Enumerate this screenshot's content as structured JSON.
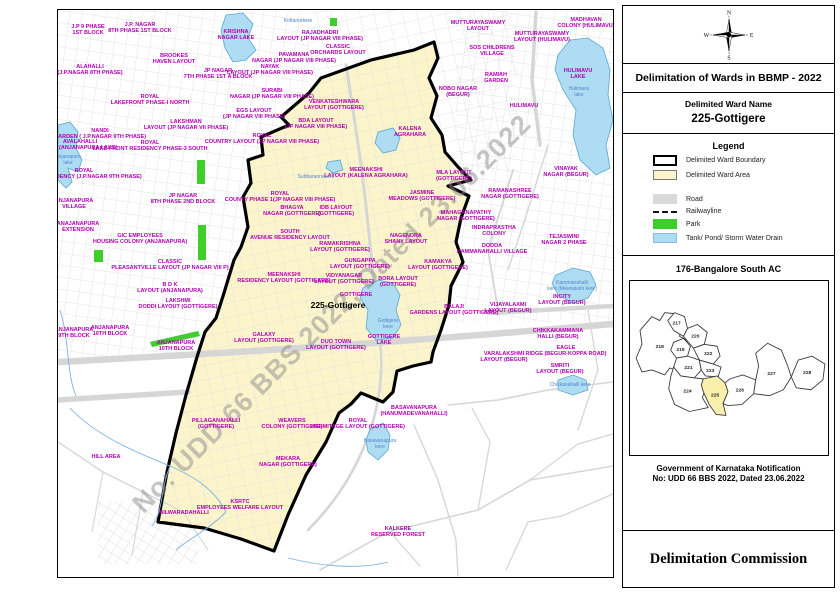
{
  "panel": {
    "title": "Delimitation of Wards in BBMP - 2022",
    "ward_name_label": "Delimited Ward Name",
    "ward_name": "225-Gottigere",
    "compass": {
      "n": "N",
      "e": "E",
      "s": "S",
      "w": "W"
    },
    "legend": {
      "title": "Legend",
      "items": [
        {
          "label": "Delimited Ward Boundary"
        },
        {
          "label": "Delimited Ward Area"
        },
        {
          "label": "Road"
        },
        {
          "label": "Railwayline"
        },
        {
          "label": "Park"
        },
        {
          "label": "Tank/ Pond/ Storm Water Drain"
        }
      ]
    },
    "ac": {
      "title": "176-Bangalore South AC",
      "highlighted_ward": "225",
      "shapes": [
        {
          "pts": "10,50 22,36 30,40 35,32 45,33 43,45 52,44 50,56 58,60 54,70 60,80 50,84 52,92 40,88 35,95 22,90 12,92 6,78 12,64"
        },
        {
          "pts": "38,40 45,32 55,36 58,48 54,56 44,50"
        },
        {
          "pts": "58,48 68,44 78,52 75,64 64,68 54,56"
        },
        {
          "pts": "44,62 54,58 61,66 58,76 47,78 41,70"
        },
        {
          "pts": "64,68 75,64 88,66 91,76 84,84 70,80"
        },
        {
          "pts": "47,78 58,76 70,80 72,90 65,98 51,96 44,87"
        },
        {
          "pts": "70,80 84,84 92,87 89,97 76,96 72,90"
        },
        {
          "pts": "44,87 51,96 65,98 74,99 77,107 73,118 79,128 60,132 45,125 39,109 41,97"
        },
        {
          "pts": "74,99 88,96 96,103 99,112 94,124 97,136 87,135 80,125 74,112 72,105",
          "hl": true
        },
        {
          "pts": "99,112 96,103 101,99 114,95 127,100 125,114 113,125 99,126 94,124"
        },
        {
          "pts": "127,100 130,86 127,73 139,63 153,70 159,85 163,97 155,110 141,116 125,114"
        },
        {
          "pts": "163,97 170,80 184,76 197,84 195,100 183,110 168,108"
        }
      ],
      "wards": [
        {
          "t": "218",
          "x": 30,
          "y": 68
        },
        {
          "t": "217",
          "x": 47,
          "y": 44
        },
        {
          "t": "220",
          "x": 66,
          "y": 57
        },
        {
          "t": "219",
          "x": 51,
          "y": 71
        },
        {
          "t": "222",
          "x": 79,
          "y": 75
        },
        {
          "t": "221",
          "x": 59,
          "y": 89
        },
        {
          "t": "223",
          "x": 81,
          "y": 92
        },
        {
          "t": "224",
          "x": 58,
          "y": 113
        },
        {
          "t": "225",
          "x": 86,
          "y": 117
        },
        {
          "t": "226",
          "x": 111,
          "y": 112
        },
        {
          "t": "227",
          "x": 143,
          "y": 95
        },
        {
          "t": "228",
          "x": 179,
          "y": 94
        }
      ]
    },
    "notification_line1": "Government of Karnataka Notification",
    "notification_line2": "No: UDD 66 BBS 2022, Dated 23.06.2022",
    "commission": "Delimitation Commission"
  },
  "map": {
    "watermark": "No: UDD 66 BBS 2022, Dated 23.06.2022",
    "colors": {
      "ward_area": "#FCF5CC",
      "boundary": "#000000",
      "water": "#AEDCF2",
      "park": "#3ECF2B",
      "road": "#D6D6D6",
      "label_magenta": "#B100B1",
      "label_blue": "#4F86C6"
    },
    "geometry": {
      "ward": "376,32 380,48 371,68 379,86 373,108 384,125 387,142 401,158 413,170 390,176 411,186 403,208 398,232 405,252 393,276 391,295 383,320 375,342 373,352 355,356 339,361 335,382 325,392 303,383 293,394 281,403 268,432 248,465 230,505 216,541 183,529 146,518 100,512 109,462 118,423 128,385 139,347 147,322 158,308 166,283 176,250 183,237 190,217 185,187 193,173 190,150 205,145 203,127 231,115 223,107 251,83 263,68 313,50 356,40",
      "pattern_rects": [
        {
          "x": 0,
          "y": 0,
          "w": 252,
          "h": 348,
          "p": "stA"
        },
        {
          "x": 252,
          "y": 0,
          "w": 206,
          "h": 162,
          "p": "stB"
        },
        {
          "x": 398,
          "y": 0,
          "w": 157,
          "h": 312,
          "p": "stA"
        },
        {
          "x": 40,
          "y": 492,
          "w": 100,
          "h": 62,
          "p": "stC"
        }
      ],
      "roads": [
        {
          "d": "M0,352 C150,344 300,336 555,314",
          "w": 6.5
        },
        {
          "d": "M0,390 L130,382",
          "w": 5.5
        },
        {
          "d": "M432,303 L555,296",
          "w": 4.5
        },
        {
          "d": "M478,2 L474,70 L482,135",
          "w": 3.5
        },
        {
          "d": "M288,55 C300,130 310,200 315,270",
          "w": 3
        },
        {
          "d": "M315,270 L322,330 C330,400 300,470 250,520",
          "w": 2.6
        },
        {
          "d": "M455,160 L430,240 L440,300",
          "w": 1.8
        },
        {
          "d": "M390,395 L440,390 L490,380 L555,372",
          "w": 1.6
        },
        {
          "d": "M356,415 L380,470 L398,530 L400,566",
          "w": 1.4
        },
        {
          "d": "M490,135 L470,200 L450,260",
          "w": 1.4
        },
        {
          "d": "M530,300 L540,360 L520,420",
          "w": 1.3
        },
        {
          "d": "M262,560 L330,522 L420,500 L472,470 L555,456",
          "w": 1.6
        },
        {
          "d": "M420,500 L432,432 L414,398",
          "w": 1.3
        },
        {
          "d": "M472,470 L520,434 L555,424",
          "w": 1.3
        },
        {
          "d": "M332,522 L362,556",
          "w": 1.3
        },
        {
          "d": "M448,560 L470,512 L504,506 L555,484",
          "w": 1.3
        },
        {
          "d": "M0,432 L45,462 L85,482 L125,502",
          "w": 1.3
        },
        {
          "d": "M45,462 L34,522",
          "w": 1.1
        },
        {
          "d": "M85,482 L74,545",
          "w": 1.1
        },
        {
          "d": "M125,502 L150,540",
          "w": 1.1
        }
      ],
      "parks": [
        "139,150 147,150 147,174 139,174",
        "140,215 148,215 148,250 140,250",
        "36,240 45,240 45,252 36,252",
        "92,332 140,321 142,326 94,337",
        "272,8 279,8 279,16 272,16"
      ],
      "streams": [
        "M12,398 C40,428 85,445 112,456 C140,468 158,482 168,502",
        "M112,456 C102,480 106,500 94,516",
        "M2,300 C12,332 8,362 18,386",
        "M168,502 C150,520 132,528 118,540",
        "M230,548 C262,556 300,560 330,552"
      ],
      "lakes": [
        "500,45 512,30 530,28 545,38 552,60 550,85 555,110 548,135 552,158 538,165 522,150 515,125 518,100 505,80 497,60",
        "168,5 185,3 195,14 190,28 198,40 188,50 175,52 167,38 163,20",
        "0,115 12,112 20,122 18,138 24,150 20,162 10,158 14,172 8,178 0,170",
        "320,122 335,118 342,128 338,140 325,143 317,133",
        "270,152 282,150 285,160 275,163 268,158",
        "305,278 320,270 335,273 342,285 338,300 343,315 335,328 318,330 308,318 310,300 302,288",
        "498,265 515,258 532,262 538,275 530,288 515,293 500,285 494,273",
        "312,420 325,413 332,425 330,440 320,450 310,442 308,430",
        "500,370 515,365 528,370 530,380 515,385 500,380"
      ]
    },
    "labels": [
      {
        "t": "J.P 9 PHASE\n1ST BLOCK",
        "x": 30,
        "y": 18
      },
      {
        "t": "J.P. NAGAR\n8TH PHASE 1ST BLOCK",
        "x": 82,
        "y": 16
      },
      {
        "t": "BROOKES\nHAVEN LAYOUT",
        "x": 116,
        "y": 47
      },
      {
        "t": "ALAHALLI\n(J.P.NAGAR 8TH PHASE)",
        "x": 32,
        "y": 58
      },
      {
        "t": "JP NAGAR\n7TH PHASE 1ST A BLOCK",
        "x": 160,
        "y": 62
      },
      {
        "t": "ROYAL\nLAKEFRONT PHASE-I NORTH",
        "x": 92,
        "y": 88
      },
      {
        "t": "LAKSHMAN\nLAYOUT (JP NAGAR VII PHASE)",
        "x": 128,
        "y": 113
      },
      {
        "t": "NANDI\nGARDEN ( J.P.NAGAR 9TH PHASE)",
        "x": 42,
        "y": 122
      },
      {
        "t": "AVALAHALLI\nLAKE (ANJANAPURA LAKE)",
        "x": 22,
        "y": 133
      },
      {
        "t": "Anjanapura\nlake",
        "x": 10,
        "y": 148,
        "c": "b"
      },
      {
        "t": "ROYAL\nLAKE FRONT RESIDENCY PHASE-3 SOUTH",
        "x": 92,
        "y": 134
      },
      {
        "t": "ROYAL\nPARK RESIDENCY (J.P.NAGAR 9TH PHASE)",
        "x": 26,
        "y": 162
      },
      {
        "t": "ANJANAPURA\nVILLAGE",
        "x": 16,
        "y": 192
      },
      {
        "t": "JP NAGAR\n8TH PHASE 2ND BLOCK",
        "x": 125,
        "y": 187
      },
      {
        "t": "ANAJANAPURA\nEXTENSION",
        "x": 20,
        "y": 215
      },
      {
        "t": "GIC EMPLOYEES\nHOUSING COLONY (ANJANAPURA)",
        "x": 82,
        "y": 227
      },
      {
        "t": "CLASSIC\nPLEASANTVILLE LAYOUT (JP NAGAR VIII P)",
        "x": 112,
        "y": 253
      },
      {
        "t": "B D K\nLAYOUT (ANJANAPURA)",
        "x": 112,
        "y": 276
      },
      {
        "t": "LAKSHMI\nDODDI LAYOUT (GOTTIGERE)",
        "x": 120,
        "y": 292
      },
      {
        "t": "ANJANAPURA\n9TH BLOCK",
        "x": 16,
        "y": 321
      },
      {
        "t": "ANJANAPURA\n10TH BLOCK",
        "x": 52,
        "y": 319
      },
      {
        "t": "ANJANAPURA\n10TH BLOCK",
        "x": 118,
        "y": 334
      },
      {
        "t": "HILL AREA",
        "x": 48,
        "y": 448
      },
      {
        "t": "KRISHNA\nNAGAR LAKE",
        "x": 178,
        "y": 23
      },
      {
        "t": "Kottanurkere",
        "x": 240,
        "y": 12,
        "c": "b"
      },
      {
        "t": "RAJADHADRI\nLAYOUT (JP NAGAR VIII PHASE)",
        "x": 262,
        "y": 24
      },
      {
        "t": "CLASSIC\nORCHARDS LAYOUT",
        "x": 280,
        "y": 38
      },
      {
        "t": "PAVAMANA\nNAGAR (JP NAGAR VIII PHASE)",
        "x": 236,
        "y": 46
      },
      {
        "t": "NAYAK\nLAYOUT (JP NAGAR VIII PHASE)",
        "x": 212,
        "y": 58
      },
      {
        "t": "SURABI\nNAGAR (JP NAGAR VIII PHASE)",
        "x": 214,
        "y": 82
      },
      {
        "t": "EGS LAYOUT\n(JP NAGAR VIII PHASE)",
        "x": 196,
        "y": 102
      },
      {
        "t": "BDA LAYOUT\n(JP NAGAR VIII PHASE)",
        "x": 258,
        "y": 112
      },
      {
        "t": "ROYAL\nCOUNTRY LAYOUT (JP NAGAR VIII PHASE)",
        "x": 204,
        "y": 127
      },
      {
        "t": "VENKATESHWARA\nLAYOUT (GOTTIGERE)",
        "x": 276,
        "y": 93
      },
      {
        "t": "KALENA\nAGRAHARA",
        "x": 352,
        "y": 120
      },
      {
        "t": "MEENAKSHI\nLAYOUT (KALENA AGRAHARA)",
        "x": 308,
        "y": 161
      },
      {
        "t": "Subbaraonakere",
        "x": 258,
        "y": 168,
        "c": "b"
      },
      {
        "t": "ROYAL\nCOUNTY PHASE 1(JP NAGAR VIII PHASE)",
        "x": 222,
        "y": 185
      },
      {
        "t": "BHAGYA\nNAGAR (GOTTIGERE)",
        "x": 234,
        "y": 199
      },
      {
        "t": "IDB LAYOUT\n(GOTTIGERE)",
        "x": 278,
        "y": 199
      },
      {
        "t": "SOUTH\nAVENUE RESIDENCY LAYOUT",
        "x": 232,
        "y": 223
      },
      {
        "t": "RAMAKRISHNA\nLAYOUT (GOTTIGERE)",
        "x": 282,
        "y": 235
      },
      {
        "t": "GUNGAPPA\nLAYOUT (GOTTIGERE)",
        "x": 302,
        "y": 252
      },
      {
        "t": "MEENAKSHI\nRESIDENCY LAYOUT (GOTTIGERE)",
        "x": 226,
        "y": 266
      },
      {
        "t": "VIDYANAGAR\nLAYOUT (GOTTIGERE)",
        "x": 286,
        "y": 267
      },
      {
        "t": "BORA LAYOUT\n(GOTTIGERE)",
        "x": 340,
        "y": 270
      },
      {
        "t": "KAMAKYA\nLAYOUT (GOTTIGERE)",
        "x": 380,
        "y": 253
      },
      {
        "t": "NAGENDRA\nSHANY LAYOUT",
        "x": 348,
        "y": 227
      },
      {
        "t": "GOTTIGERE",
        "x": 298,
        "y": 286
      },
      {
        "t": "225-Gottigere",
        "x": 280,
        "y": 298,
        "c": "k"
      },
      {
        "t": "GALAXY\nLAYOUT (GOTTIGERE)",
        "x": 206,
        "y": 326
      },
      {
        "t": "DUO TOWN\nLAYOUT (GOTTIGERE)",
        "x": 278,
        "y": 333
      },
      {
        "t": "Gottigere\nkere",
        "x": 330,
        "y": 312,
        "c": "b"
      },
      {
        "t": "GOTTIGERE\nLAKE",
        "x": 326,
        "y": 328
      },
      {
        "t": "PILLAGANAHALLI\n(GOTTIGERE)",
        "x": 158,
        "y": 412
      },
      {
        "t": "WEAVERS\nCOLONY (GOTTIGERE)",
        "x": 234,
        "y": 412
      },
      {
        "t": "ROYAL\nHERMITAGE LAYOUT (GOTTIGERE)",
        "x": 300,
        "y": 412
      },
      {
        "t": "MEKARA\nNAGAR (GOTTIGERE)",
        "x": 230,
        "y": 450
      },
      {
        "t": "KSRTC\nEMPLOYEES WELFARE LAYOUT",
        "x": 182,
        "y": 493
      },
      {
        "t": "BILWARADAHALLI",
        "x": 126,
        "y": 504
      },
      {
        "t": "BASAVANAPURA\n(HANUMADEVANAHALLI)",
        "x": 356,
        "y": 399
      },
      {
        "t": "Basavanapura\nkere",
        "x": 322,
        "y": 432,
        "c": "b"
      },
      {
        "t": "KALKERE\nRESERVED FOREST",
        "x": 340,
        "y": 520
      },
      {
        "t": "MUTTURAYASWAMY\nLAYOUT",
        "x": 420,
        "y": 14
      },
      {
        "t": "MUTTURAYASWAMY\nLAYOUT (HULIMAVU)",
        "x": 484,
        "y": 25
      },
      {
        "t": "MADHAVAN\nCOLONY (HULIMAVU)",
        "x": 528,
        "y": 11
      },
      {
        "t": "SOS CHILDRENS\nVILLAGE",
        "x": 434,
        "y": 39
      },
      {
        "t": "RAMIAH\nGARDEN",
        "x": 438,
        "y": 66
      },
      {
        "t": "NOBO NAGAR\n(BEGUR)",
        "x": 400,
        "y": 80
      },
      {
        "t": "HULIMAVU\nLAKE",
        "x": 520,
        "y": 62
      },
      {
        "t": "Hulimavu\nlake",
        "x": 521,
        "y": 80,
        "c": "b"
      },
      {
        "t": "HULIMAVU",
        "x": 466,
        "y": 97
      },
      {
        "t": "VINAYAK\nNAGAR (BEGUR)",
        "x": 508,
        "y": 160
      },
      {
        "t": "RAMANASHREE\nNAGAR (GOTTIGERE)",
        "x": 452,
        "y": 182
      },
      {
        "t": "MLA LAYOUT\n(GOTTIGERE)",
        "x": 396,
        "y": 164
      },
      {
        "t": "JASMINE\nMEADOWS (GOTTIGERE)",
        "x": 364,
        "y": 184
      },
      {
        "t": "MAHAGANAPATHY\nNAGAR (GOTTIGERE)",
        "x": 408,
        "y": 204
      },
      {
        "t": "INDRAPRASTHA\nCOLONY",
        "x": 436,
        "y": 219
      },
      {
        "t": "DODDA\nKAMMANAHALLI VILLAGE",
        "x": 434,
        "y": 237
      },
      {
        "t": "TEJASWINI\nNAGAR 2 PHASE",
        "x": 506,
        "y": 228
      },
      {
        "t": "VIJAYALAXMI\nLAYOUT (BEGUR)",
        "x": 450,
        "y": 296
      },
      {
        "t": "INCITY\nLAYOUT (BEGUR)",
        "x": 504,
        "y": 288
      },
      {
        "t": "Kammanahalli\nkere (Meenakshi kere)",
        "x": 514,
        "y": 274,
        "c": "b"
      },
      {
        "t": "CHIKKAKAMMANA\nHALLI (BEGUR)",
        "x": 500,
        "y": 322
      },
      {
        "t": "EAGLE\nRIDGE (BEGUR-KOPPA ROAD)",
        "x": 508,
        "y": 339
      },
      {
        "t": "VARALAKSHMI\nLAYOUT (BEGUR)",
        "x": 446,
        "y": 345
      },
      {
        "t": "SMRITI\nLAYOUT (BEGUR)",
        "x": 502,
        "y": 357
      },
      {
        "t": "Chikkanahalli kere",
        "x": 512,
        "y": 376,
        "c": "b"
      },
      {
        "t": "BALAJI\nGARDENS LAYOUT (GOTTIGERE)",
        "x": 396,
        "y": 298
      }
    ]
  }
}
